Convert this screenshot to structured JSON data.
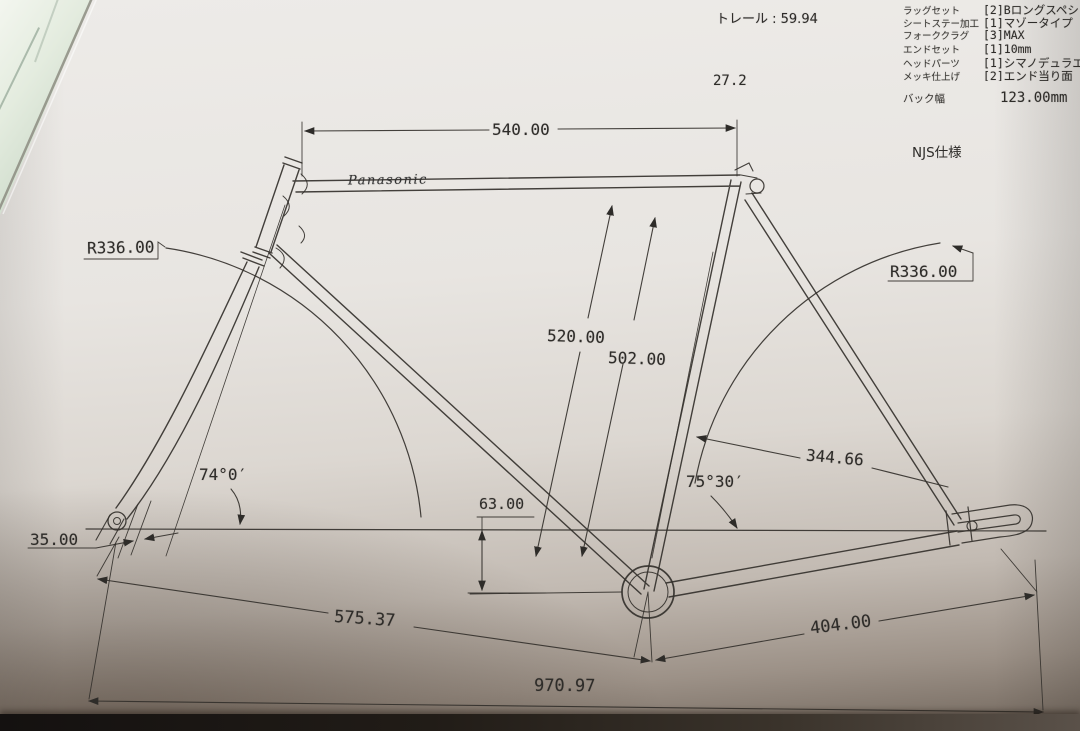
{
  "drawing_title": {
    "brand_logo": "Panasonic",
    "standard": "NJS仕様"
  },
  "annotations": {
    "trail": "トレール : 59.94",
    "seatpost_diameter": "27.2"
  },
  "spec_table": {
    "rows": [
      {
        "label": "ラッグセット",
        "value": "[2]Bロングスペシャル"
      },
      {
        "label": "シートステー加工",
        "value": "[1]マゾータイプ"
      },
      {
        "label": "フォーククラグ",
        "value": "[3]MAX"
      },
      {
        "label": "エンドセット",
        "value": "[1]10mm"
      },
      {
        "label": "ヘッドパーツ",
        "value": "[1]シマノデュラエース"
      },
      {
        "label": "メッキ仕上げ",
        "value": "[2]エンド当り面"
      }
    ],
    "back_width": {
      "label": "バック幅",
      "value": "123.00mm"
    }
  },
  "dimensions": {
    "top_tube": "540.00",
    "front_wheel_radius": "R336.00",
    "rear_wheel_radius": "R336.00",
    "seat_tube_full": "520.00",
    "seat_tube_c_to_c": "502.00",
    "head_angle": "74°0′",
    "seat_angle": "75°30′",
    "seat_stay": "344.66",
    "bb_drop": "63.00",
    "fork_offset": "35.00",
    "front_center": "575.37",
    "rear_center": "404.00",
    "wheelbase": "970.97"
  },
  "colors": {
    "ink": "#2e2c29",
    "paper": "#e6e3df",
    "marble_corner": "#d7e3d4",
    "bottom_shadow": "#6a5f56"
  }
}
